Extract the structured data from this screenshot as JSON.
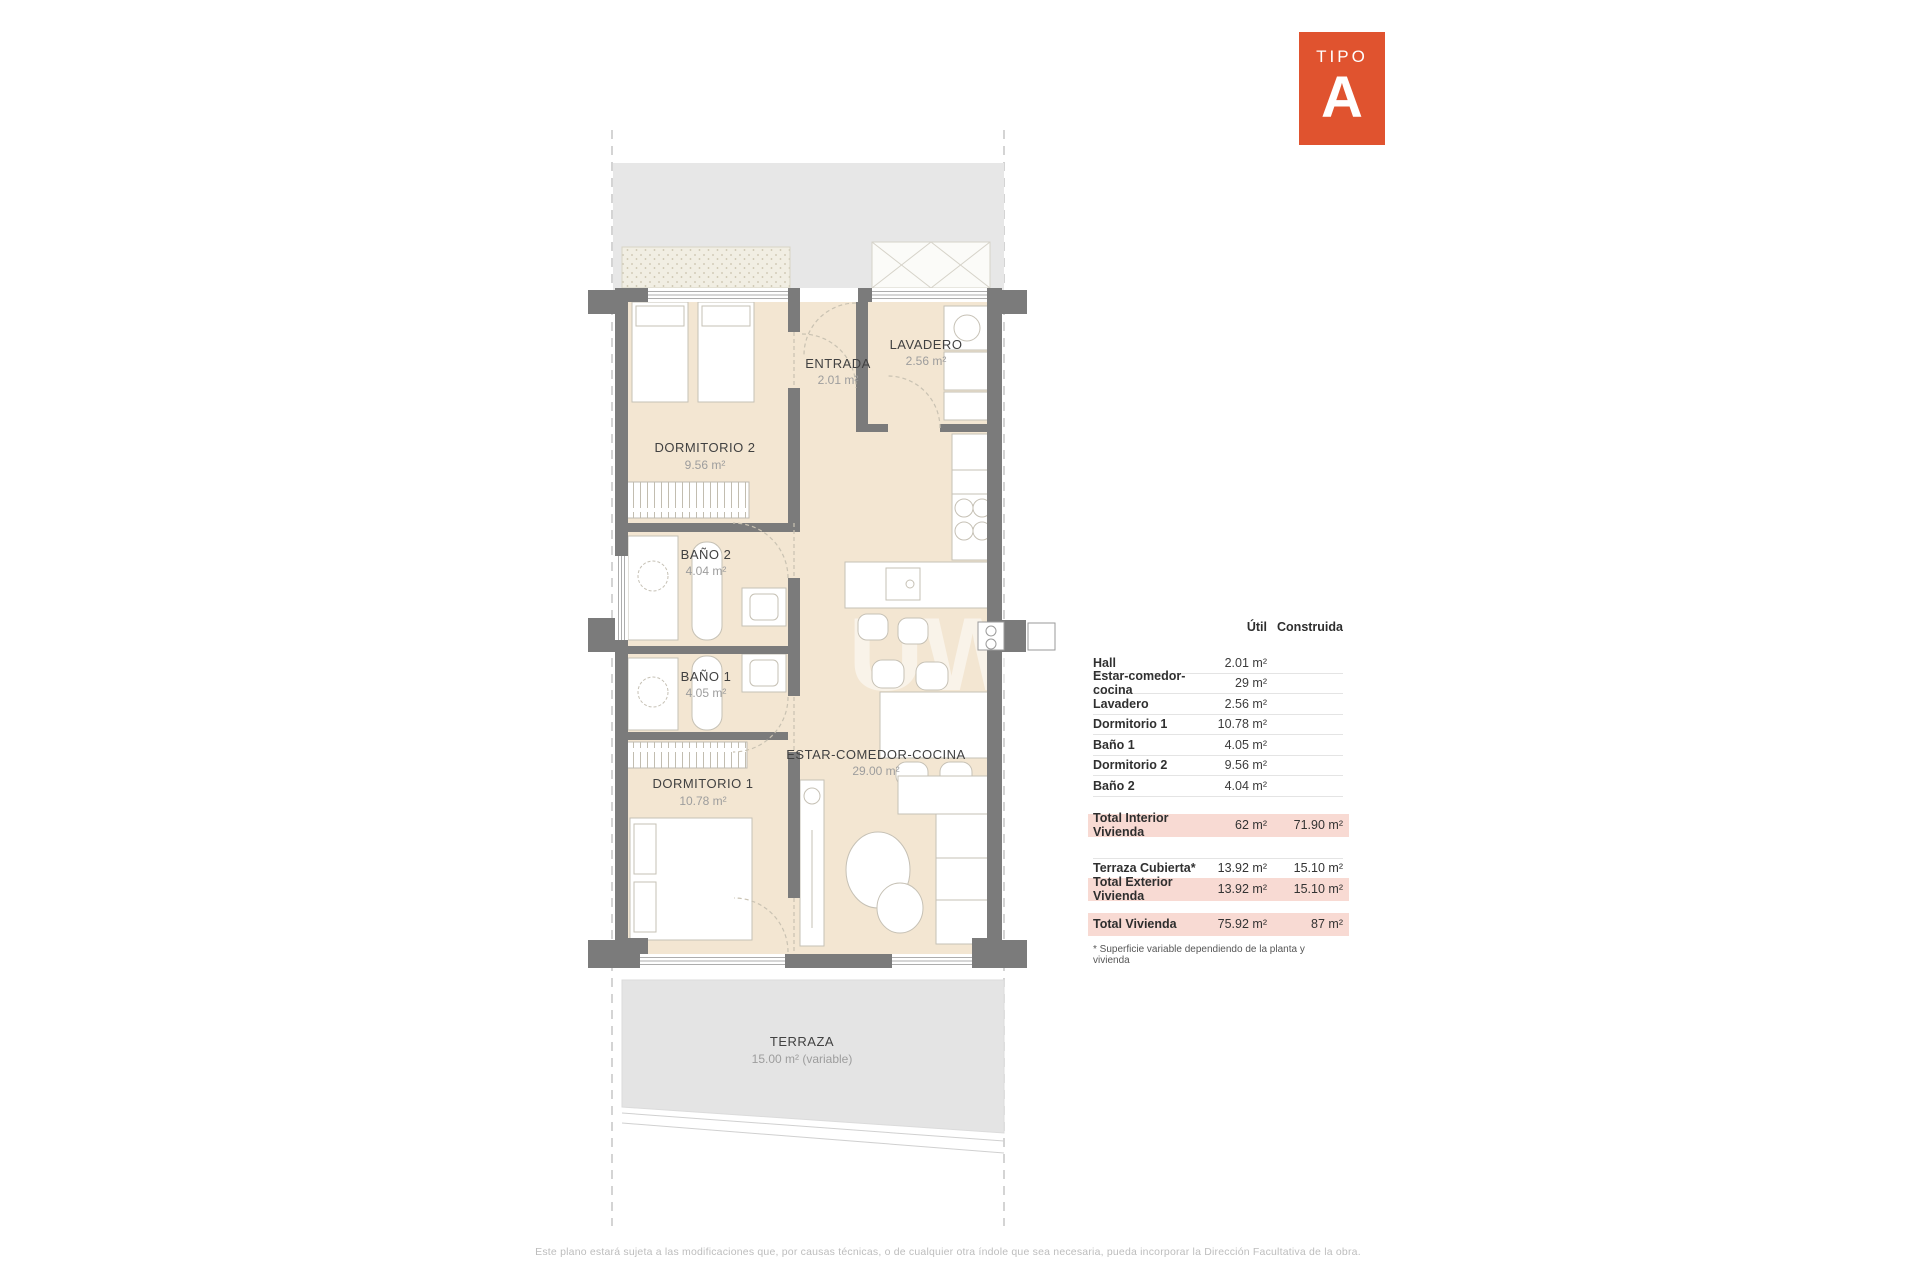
{
  "badge": {
    "label": "TIPO",
    "letter": "A"
  },
  "plan": {
    "rooms": {
      "dormitorio2": {
        "name": "DORMITORIO 2",
        "area": "9.56 m²"
      },
      "entrada": {
        "name": "ENTRADA",
        "area": "2.01 m²"
      },
      "lavadero": {
        "name": "LAVADERO",
        "area": "2.56 m²"
      },
      "bano2": {
        "name": "BAÑO 2",
        "area": "4.04 m²"
      },
      "bano1": {
        "name": "BAÑO 1",
        "area": "4.05 m²"
      },
      "dormitorio1": {
        "name": "DORMITORIO 1",
        "area": "10.78 m²"
      },
      "estar": {
        "name": "ESTAR-COMEDOR-COCINA",
        "area": "29.00 m²"
      },
      "terraza": {
        "name": "TERRAZA",
        "area": "15.00 m² (variable)"
      }
    },
    "watermark": "UW"
  },
  "table": {
    "header": {
      "util": "Útil",
      "construida": "Construida"
    },
    "rows": [
      {
        "label": "Hall",
        "util": "2.01 m²",
        "construida": ""
      },
      {
        "label": "Estar-comedor-cocina",
        "util": "29 m²",
        "construida": ""
      },
      {
        "label": "Lavadero",
        "util": "2.56 m²",
        "construida": ""
      },
      {
        "label": "Dormitorio 1",
        "util": "10.78 m²",
        "construida": ""
      },
      {
        "label": "Baño 1",
        "util": "4.05 m²",
        "construida": ""
      },
      {
        "label": "Dormitorio 2",
        "util": "9.56 m²",
        "construida": ""
      },
      {
        "label": "Baño 2",
        "util": "4.04 m²",
        "construida": ""
      }
    ],
    "summary": {
      "total_interior": {
        "label": "Total Interior Vivienda",
        "util": "62 m²",
        "construida": "71.90 m²"
      },
      "terraza_cubierta": {
        "label": "Terraza Cubierta*",
        "util": "13.92 m²",
        "construida": "15.10 m²"
      },
      "total_exterior": {
        "label": "Total Exterior Vivienda",
        "util": "13.92 m²",
        "construida": "15.10 m²"
      },
      "total_vivienda": {
        "label": "Total Vivienda",
        "util": "75.92 m²",
        "construida": "87 m²"
      }
    },
    "footnote": "* Superficie variable dependiendo de la planta y vivienda"
  },
  "footer": {
    "disclaimer": "Este plano estará sujeta a las modificaciones que, por causas técnicas, o de cualquier otra índole que sea necesaria, pueda incorporar la Dirección Facultativa de la obra."
  },
  "colors": {
    "accent": "#E0532F",
    "highlight": "#F8DAD3",
    "wall": "#7B7B7B",
    "floor": "#F3E6D2",
    "corridor": "#E7E7E7",
    "terrace": "#E4E4E4"
  }
}
